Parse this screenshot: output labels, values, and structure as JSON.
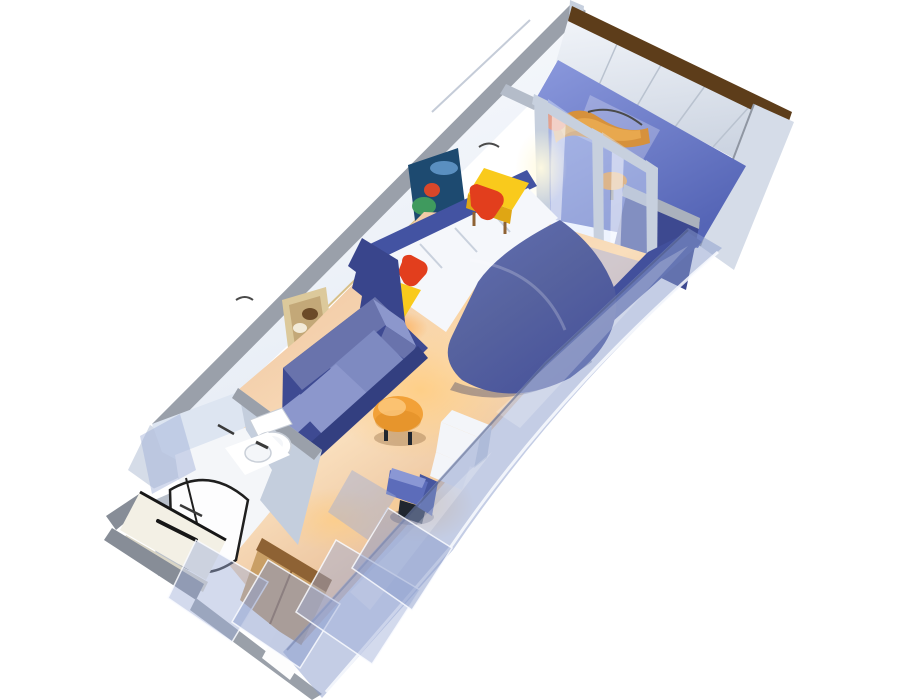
{
  "scene": {
    "type": "3d-cutaway-floorplan",
    "subject": "cruise-ship-balcony-stateroom",
    "rooms": [
      "stateroom",
      "bathroom",
      "entry-corridor",
      "balcony"
    ],
    "furniture": [
      "queen-bed",
      "nightstands",
      "sofa",
      "ottoman-table",
      "desk-chair",
      "desk-cabinet",
      "wardrobe",
      "balcony-lounge-chair",
      "balcony-table",
      "toilet",
      "sink",
      "shower"
    ]
  },
  "colors": {
    "bg": "#ffffff",
    "wall_face_light": "#fbfcfe",
    "wall_face_shade": "#e6ecf5",
    "wall_edge": "#9aa0aa",
    "wall_edge_dark": "#6e747e",
    "wall_seam": "#c5ccd8",
    "wall_ledge": "#b4bcc9",
    "baseboard_gold": "#d8c089",
    "rail_brown": "#5d3d1a",
    "rail_face": "#f1f4f9",
    "rail_face_shade": "#ccd4e1",
    "rail_seam": "#b9c2cf",
    "balcony_wall": "#d5dce8",
    "balcony_wall_edge": "#8f96a2",
    "balcony_floor": "#5565b6",
    "balcony_floor_light": "#8b99dd",
    "balcony_streak": "rgba(255,255,255,0.25)",
    "partition_navy": "#3d4990",
    "partition_cap": "#aab1bd",
    "glass_fill": "rgba(215,228,252,0.45)",
    "glass_streak": "rgba(255,255,255,0.5)",
    "frame_post": "#c7d0de",
    "threshold": "#b7c0d0",
    "floor_main": "#eec09a",
    "floor_light": "#f9debc",
    "floor_edge_dark": "#d89d72",
    "glow_warm": "rgba(255,205,130,0.9)",
    "glow_warm_fade": "rgba(255,205,130,0)",
    "lamp_glow": "rgba(255,170,75,0.95)",
    "lamp_glow_fade": "rgba(255,170,75,0)",
    "flare": "rgba(255,250,225,0.95)",
    "flare_fade": "rgba(255,250,225,0)",
    "floor_blue_streak": "rgba(145,165,235,0.38)",
    "parapet_navy": "#42509c",
    "bed_duvet_light": "#626fb4",
    "bed_duvet": "#57639f",
    "bed_duvet_dark": "#47529b",
    "bed_shadow": "rgba(35,45,95,0.35)",
    "headboard": "#4353a2",
    "sheet_white": "#f5f7fb",
    "pillow_line": "#c9d1dd",
    "cushion_red": "#e23e1d",
    "cushion_red_dark": "#b22c10",
    "stand_yellow": "#f9ca1c",
    "stand_yellow_dark": "#dfa614",
    "sail_navy": "#39458c",
    "sofa_base": "#3e4a92",
    "sofa_back": "#6973ac",
    "sofa_cushion": "#7e8ac1",
    "sofa_cushion_light": "#8c97cc",
    "sofa_front": "#333f80",
    "ottoman_orange": "#f2a138",
    "ottoman_dark": "#d9881f",
    "ottoman_hi": "#ffd08a",
    "chair_seat": "#5c6cba",
    "chair_seat_hi": "#8a97d4",
    "chair_back": "#47569f",
    "chair_base": "#20262f",
    "desk_white": "#f3f5f9",
    "desk_side": "#d3dae6",
    "bath_wall": "#dde5f1",
    "bath_wall2": "#c4cedd",
    "bath_floor": "#f4f6f9",
    "shower_glass": "#fdfdfe",
    "shower_line": "#1f1f1f",
    "shower_frame": "#b9c0cb",
    "fixture_white": "#ffffff",
    "fixture_line": "#c9cfd8",
    "fixture_dark": "#3a3a3a",
    "door_cream": "#f3f0e5",
    "door_shade": "#d9d5c6",
    "door_edge": "#171717",
    "outer_gray": "#878d97",
    "outer_gray2": "#9aa0a9",
    "wardrobe_tan": "#c99f66",
    "wardrobe_dark": "#8e6234",
    "gap_white": "#fdfdfd",
    "trans_wall": "rgba(138,156,204,0.5)",
    "trans_wall2": "rgba(158,174,216,0.45)",
    "trans_edge": "rgba(250,252,255,0.85)",
    "trans_dark_edge": "rgba(70,82,120,0.45)",
    "trans_streak": "rgba(255,255,255,0.22)",
    "pic1_bg": "#1d4a70",
    "pic1_green": "#3f9a5e",
    "pic1_red": "#d8472a",
    "pic1_blue": "#5a8fc0",
    "pic2_frame": "#dcc99b",
    "pic2_bg": "#c3a878",
    "pic2_dark": "#6b4a28",
    "pic2_light": "#f2ead8",
    "sconce": "#4a4a4a",
    "lounge_orange": "#d6913c",
    "lounge_orange2": "#e8a84e",
    "lounge_red": "#ee6a34",
    "balc_table": "#e08f2e"
  }
}
